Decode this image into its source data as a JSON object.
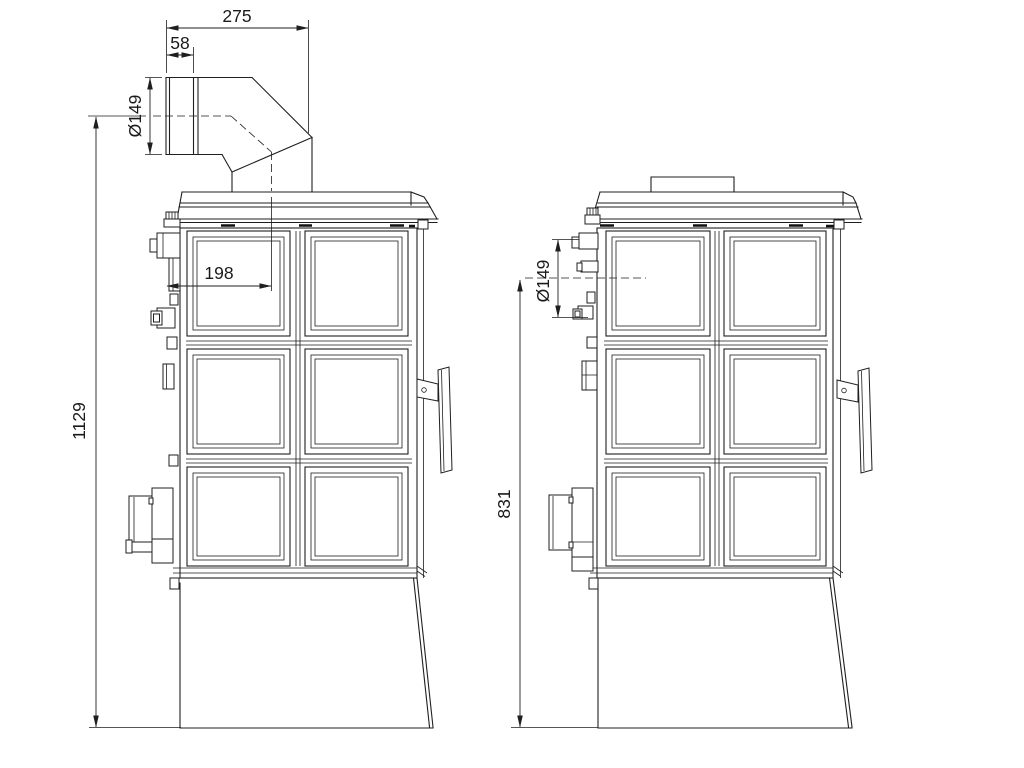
{
  "drawing": {
    "background": "#ffffff",
    "line_color": "#1f1f1f",
    "views": {
      "left_view": {
        "dimensions": {
          "pipe_depth_total": "275",
          "pipe_socket_length": "58",
          "flue_pipe_diameter": "Ø149",
          "flue_center_offset": "198",
          "overall_height": "1129"
        }
      },
      "right_view": {
        "dimensions": {
          "rear_outlet_height": "831",
          "rear_outlet_diameter": "Ø149"
        }
      }
    }
  }
}
